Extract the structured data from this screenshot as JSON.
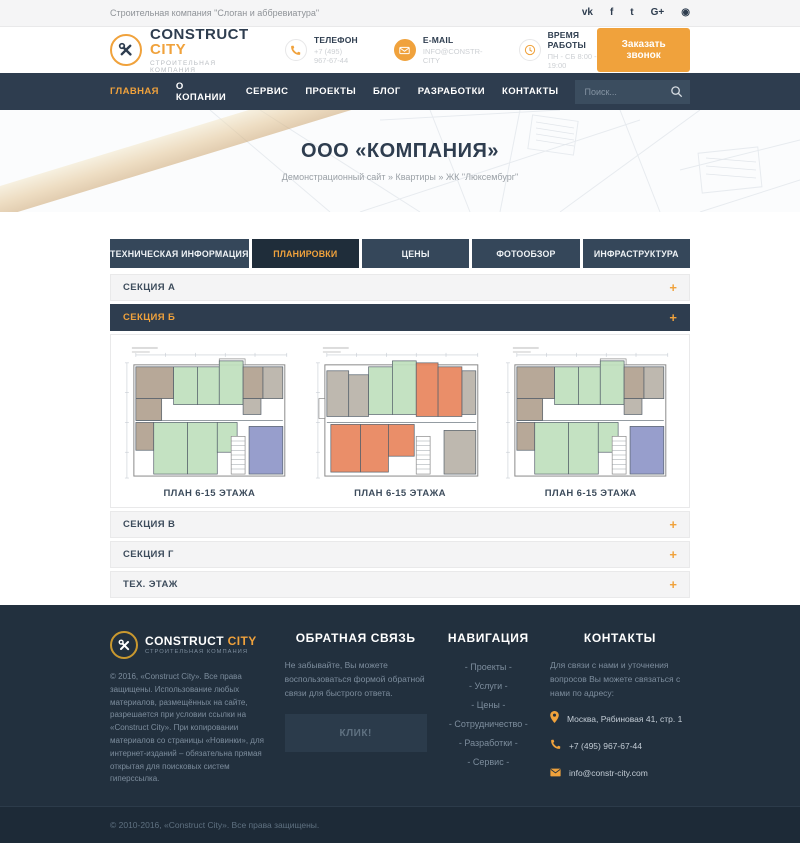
{
  "colors": {
    "accent": "#f0a23c",
    "nav_bg": "#2e3d4f",
    "tab_bg": "#35475a",
    "tab_active_bg": "#1f2d3a",
    "footer_bg": "#22303e",
    "footer_bottom_bg": "#1d2a37",
    "plan_green": "#bfe0bd",
    "plan_tan": "#b1a18f",
    "plan_gray": "#b9b2a8",
    "plan_blue": "#8e96c8",
    "plan_orange": "#e8845c"
  },
  "topbar": {
    "tagline": "Строительная компания \"Слоган и аббревиатура\"",
    "social": [
      {
        "name": "vk",
        "glyph": "vk"
      },
      {
        "name": "facebook",
        "glyph": "f"
      },
      {
        "name": "twitter",
        "glyph": "t"
      },
      {
        "name": "google-plus",
        "glyph": "G+"
      },
      {
        "name": "circle-network",
        "glyph": "◉"
      }
    ]
  },
  "header": {
    "logo": {
      "name_primary": "CONSTRUCT",
      "name_accent": "CITY",
      "subtitle": "СТРОИТЕЛЬНАЯ КОМПАНИЯ"
    },
    "contacts": [
      {
        "label": "ТЕЛЕФОН",
        "value": "+7 (495) 967-67-44"
      },
      {
        "label": "E-MAIL",
        "value": "INFO@CONSTR-CITY"
      },
      {
        "label": "ВРЕМЯ РАБОТЫ",
        "value": "ПН - СБ 8:00 - 19:00"
      }
    ],
    "cta_label": "Заказать звонок"
  },
  "nav": {
    "items": [
      {
        "label": "ГЛАВНАЯ"
      },
      {
        "label": "О КОПАНИИ"
      },
      {
        "label": "СЕРВИС"
      },
      {
        "label": "ПРОЕКТЫ"
      },
      {
        "label": "БЛОГ"
      },
      {
        "label": "РАЗРАБОТКИ"
      },
      {
        "label": "КОНТАКТЫ"
      }
    ],
    "search_placeholder": "Поиск..."
  },
  "hero": {
    "title": "ООО «КОМПАНИЯ»",
    "breadcrumb": "Демонстрационный сайт » Квартиры » ЖК \"Люксембург\""
  },
  "tabs": [
    {
      "label": "ТЕХНИЧЕСКАЯ ИНФОРМАЦИЯ"
    },
    {
      "label": "ПЛАНИРОВКИ"
    },
    {
      "label": "ЦЕНЫ"
    },
    {
      "label": "ФОТООБЗОР"
    },
    {
      "label": "ИНФРАСТРУКТУРА"
    }
  ],
  "accordion": {
    "toggle_glyph": "+",
    "sections": [
      {
        "label": "СЕКЦИЯ А"
      },
      {
        "label": "СЕКЦИЯ Б"
      },
      {
        "label": "СЕКЦИЯ В"
      },
      {
        "label": "СЕКЦИЯ Г"
      },
      {
        "label": "ТЕХ. ЭТАЖ"
      }
    ],
    "plans": [
      {
        "caption": "ПЛАН 6-15 ЭТАЖА",
        "variant": "blue"
      },
      {
        "caption": "ПЛАН 6-15 ЭТАЖА",
        "variant": "orange"
      },
      {
        "caption": "ПЛАН 6-15 ЭТАЖА",
        "variant": "blue"
      }
    ]
  },
  "footer": {
    "logo": {
      "name_primary": "CONSTRUCT",
      "name_accent": "CITY",
      "subtitle": "СТРОИТЕЛЬНАЯ КОМПАНИЯ"
    },
    "about": "© 2016, «Construct City». Все права защищены. Использование любых материалов, размещённых на сайте, разрешается при условии ссылки на «Construct City». При копировании материалов со страницы «Новинки», для интернет-изданий – обязательна прямая открытая для поисковых систем гиперссылка.",
    "feedback": {
      "title": "ОБРАТНАЯ СВЯЗЬ",
      "text": "Не забывайте, Вы можете воспользоваться формой обратной связи для быстрого ответа.",
      "button_label": "КЛИК!"
    },
    "navigation": {
      "title": "НАВИГАЦИЯ",
      "links": [
        "- Проекты -",
        "- Услуги -",
        "- Цены -",
        "- Сотрудничество -",
        "- Разработки -",
        "- Сервис -"
      ]
    },
    "contacts": {
      "title": "КОНТАКТЫ",
      "text": "Для связи с нами и уточнения вопросов Вы можете связаться с нами по адресу:",
      "items": [
        {
          "icon": "pin",
          "value": "Москва, Рябиновая 41, стр. 1"
        },
        {
          "icon": "phone",
          "value": "+7 (495) 967-67-44"
        },
        {
          "icon": "envelope",
          "value": "info@constr-city.com"
        }
      ]
    },
    "copyright": "© 2010-2016, «Construct City». Все права защищены."
  }
}
